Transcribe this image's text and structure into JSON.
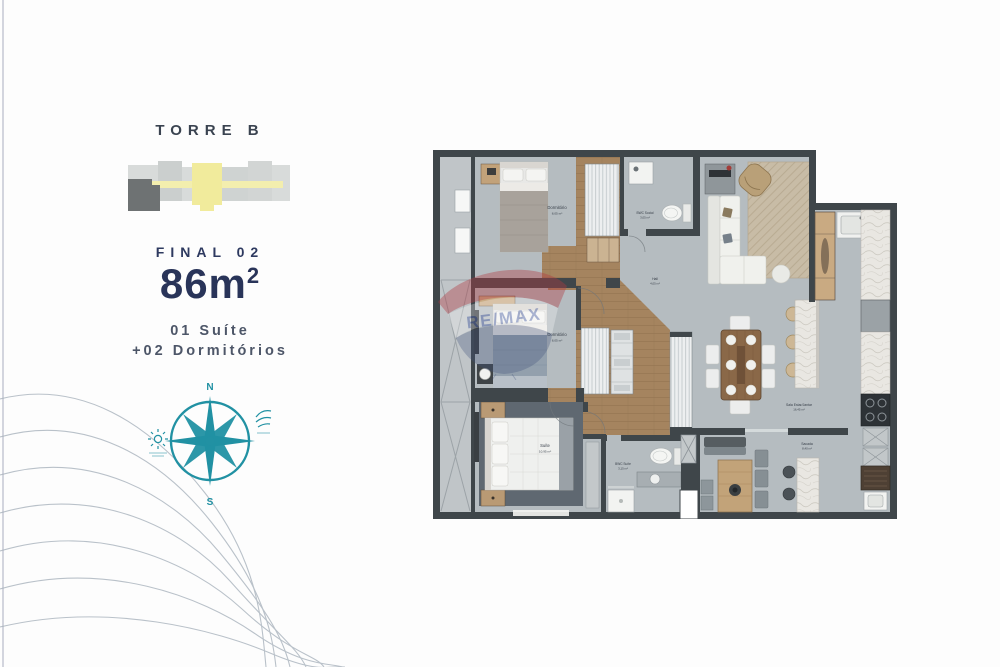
{
  "panel": {
    "tower": "TORRE B",
    "final": "FINAL 02",
    "area": "86m",
    "area_sup": "2",
    "feat1": "01 Suíte",
    "feat2": "+02 Dormitórios"
  },
  "compass": {
    "n": "N",
    "s": "S"
  },
  "watermark": {
    "brand": "RE/MAX"
  },
  "rooms": {
    "dorm1": {
      "name": "Dormitório",
      "area": "8,05 m²"
    },
    "dorm2": {
      "name": "Dormitório",
      "area": "8,05 m²"
    },
    "suite": {
      "name": "Suíte",
      "area": "10,95 m²"
    },
    "bwc_social": {
      "name": "BWC Social",
      "area": "3,05 m²"
    },
    "bwc_suite": {
      "name": "BWC Suíte",
      "area": "3,15 m²"
    },
    "hall": {
      "name": "Hall",
      "area": "4,05 m²"
    },
    "living": {
      "name": "Sala Estar/Jantar",
      "area": "16,45 m²"
    },
    "balcony": {
      "name": "Sacada",
      "area": "8,40 m²"
    }
  },
  "colors": {
    "navy": "#293459",
    "teal": "#2191a3",
    "wall": "#3f464a",
    "floor": "#b5bcc0",
    "wood": "#a5845f",
    "core_yellow": "#f1eb9c",
    "watermark_red": "#b23a42",
    "watermark_blue": "#41527c"
  }
}
